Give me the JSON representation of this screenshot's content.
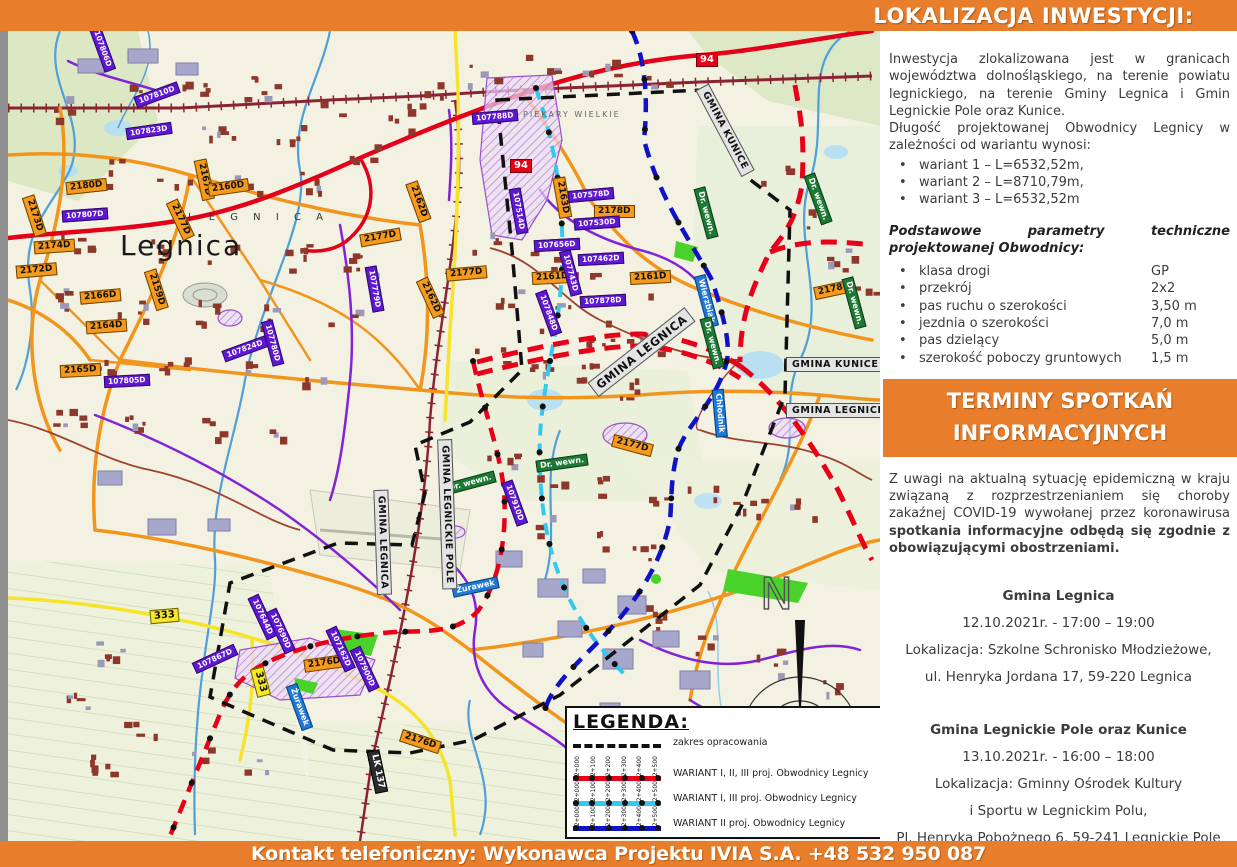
{
  "header": {
    "title": "LOKALIZACJA INWESTYCJI:"
  },
  "intro": {
    "p1": "Inwestycja zlokalizowana jest w granicach województwa dolnośląskiego, na terenie powiatu legnickiego, na terenie Gminy Legnica  i Gmin Legnickie Pole oraz Kunice.",
    "p2": "Długość projektowanej Obwodnicy Legnicy w zależności od wariantu wynosi:",
    "variants": [
      "wariant 1 – L=6532,52m,",
      "wariant 2 – L=8710,79m,",
      "wariant 3 – L=6532,52m"
    ]
  },
  "parameters": {
    "heading": "Podstawowe parametry techniczne projektowanej Obwodnicy:",
    "items": [
      {
        "label": "klasa drogi",
        "value": "GP"
      },
      {
        "label": "przekrój",
        "value": "2x2"
      },
      {
        "label": "pas ruchu o szerokości",
        "value": "3,50 m"
      },
      {
        "label": "jezdnia o szerokości",
        "value": "7,0 m"
      },
      {
        "label": "pas dzielący",
        "value": "5,0 m"
      },
      {
        "label": "szerokość poboczy gruntowych",
        "value": "1,5 m"
      }
    ]
  },
  "meetings": {
    "title_line1": "TERMINY SPOTKAŃ",
    "title_line2": "INFORMACYJNYCH",
    "covid_normal": "Z uwagi na aktualną sytuację epidemiczną w kraju związaną z rozprzestrzenianiem się choroby zakaźnej COVID-19 wywołanej przez koronawirusa ",
    "covid_bold": "spotkania informacyjne odbędą się zgodnie z obowiązującymi obostrzeniami.",
    "sessions": [
      {
        "name": "Gmina Legnica",
        "date": "12.10.2021r. - 17:00 – 19:00",
        "loc1": "Lokalizacja:  Szkolne Schronisko Młodzieżowe,",
        "loc2": "ul. Henryka Jordana 17, 59-220 Legnica",
        "loc3": ""
      },
      {
        "name": "Gmina Legnickie Pole oraz Kunice",
        "date": "13.10.2021r. - 16:00 – 18:00",
        "loc1": "Lokalizacja:  Gminny Ośrodek Kultury",
        "loc2": "i Sportu w Legnickim Polu,",
        "loc3": "Pl. Henryka Pobożnego 6, 59-241 Legnickie Pole"
      }
    ]
  },
  "footer": {
    "contact": "Kontakt telefoniczny: Wykonawca Projektu IVIA S.A. +48 532 950 087"
  },
  "legend": {
    "title": "LEGENDA:",
    "items": [
      {
        "label": "zakres opracowania"
      },
      {
        "label": "WARIANT I, II, III proj. Obwodnicy Legnicy"
      },
      {
        "label": "WARIANT I, III  proj. Obwodnicy Legnicy"
      },
      {
        "label": "WARIANT II proj. Obwodnicy Legnicy"
      }
    ],
    "chainage": [
      "2+000",
      "2+100",
      "2+200",
      "2+300",
      "2+400",
      "2+500"
    ]
  },
  "map": {
    "city_large": "Legnica",
    "city_small": "L E G N I C A",
    "district": "PIEKARY WIELKIE",
    "north_label": "N",
    "badges": [
      "2180D",
      "2173D",
      "2174D",
      "2172D",
      "2166D",
      "2164D",
      "2165D",
      "2159D",
      "2177D",
      "2167D",
      "2160D",
      "2177D",
      "2162D",
      "2162D",
      "2163D",
      "2178D",
      "2161D",
      "2161D",
      "2177D",
      "2178D",
      "2177D",
      "2176D",
      "2176D",
      "94",
      "94",
      "333",
      "333",
      "Żurawek",
      "Żurawek",
      "Wierzbiak",
      "Chłodnik",
      "Dr. wewn.",
      "Dr. wewn.",
      "Dr. wewn.",
      "Dr. wewn.",
      "Dr. wewn.",
      "Dr. wewn.",
      "LK 137",
      "107823D",
      "107806D",
      "107810D",
      "107807D",
      "107805D",
      "107788D",
      "107578D",
      "107530D",
      "107656D",
      "107462D",
      "107878D",
      "107743D",
      "107848D",
      "107514D",
      "107824D",
      "107780D",
      "107779D",
      "107644D",
      "107690D",
      "107162D",
      "107900D",
      "107867D",
      "107910D"
    ],
    "gmina_labels": [
      "GMINA KUNICE",
      "GMINA LEGNICA",
      "GMINA LEGNICA",
      "GMINA LEGNICKIE POLE",
      "GMINA KUNICE",
      "GMINA LEGNICKIE POLE"
    ]
  },
  "colors": {
    "accent_orange": "#e87e2b",
    "variant_red": "#e80019",
    "variant_cyan": "#35c8ee",
    "variant_blue": "#1012c8",
    "boundary_black": "#111111"
  }
}
